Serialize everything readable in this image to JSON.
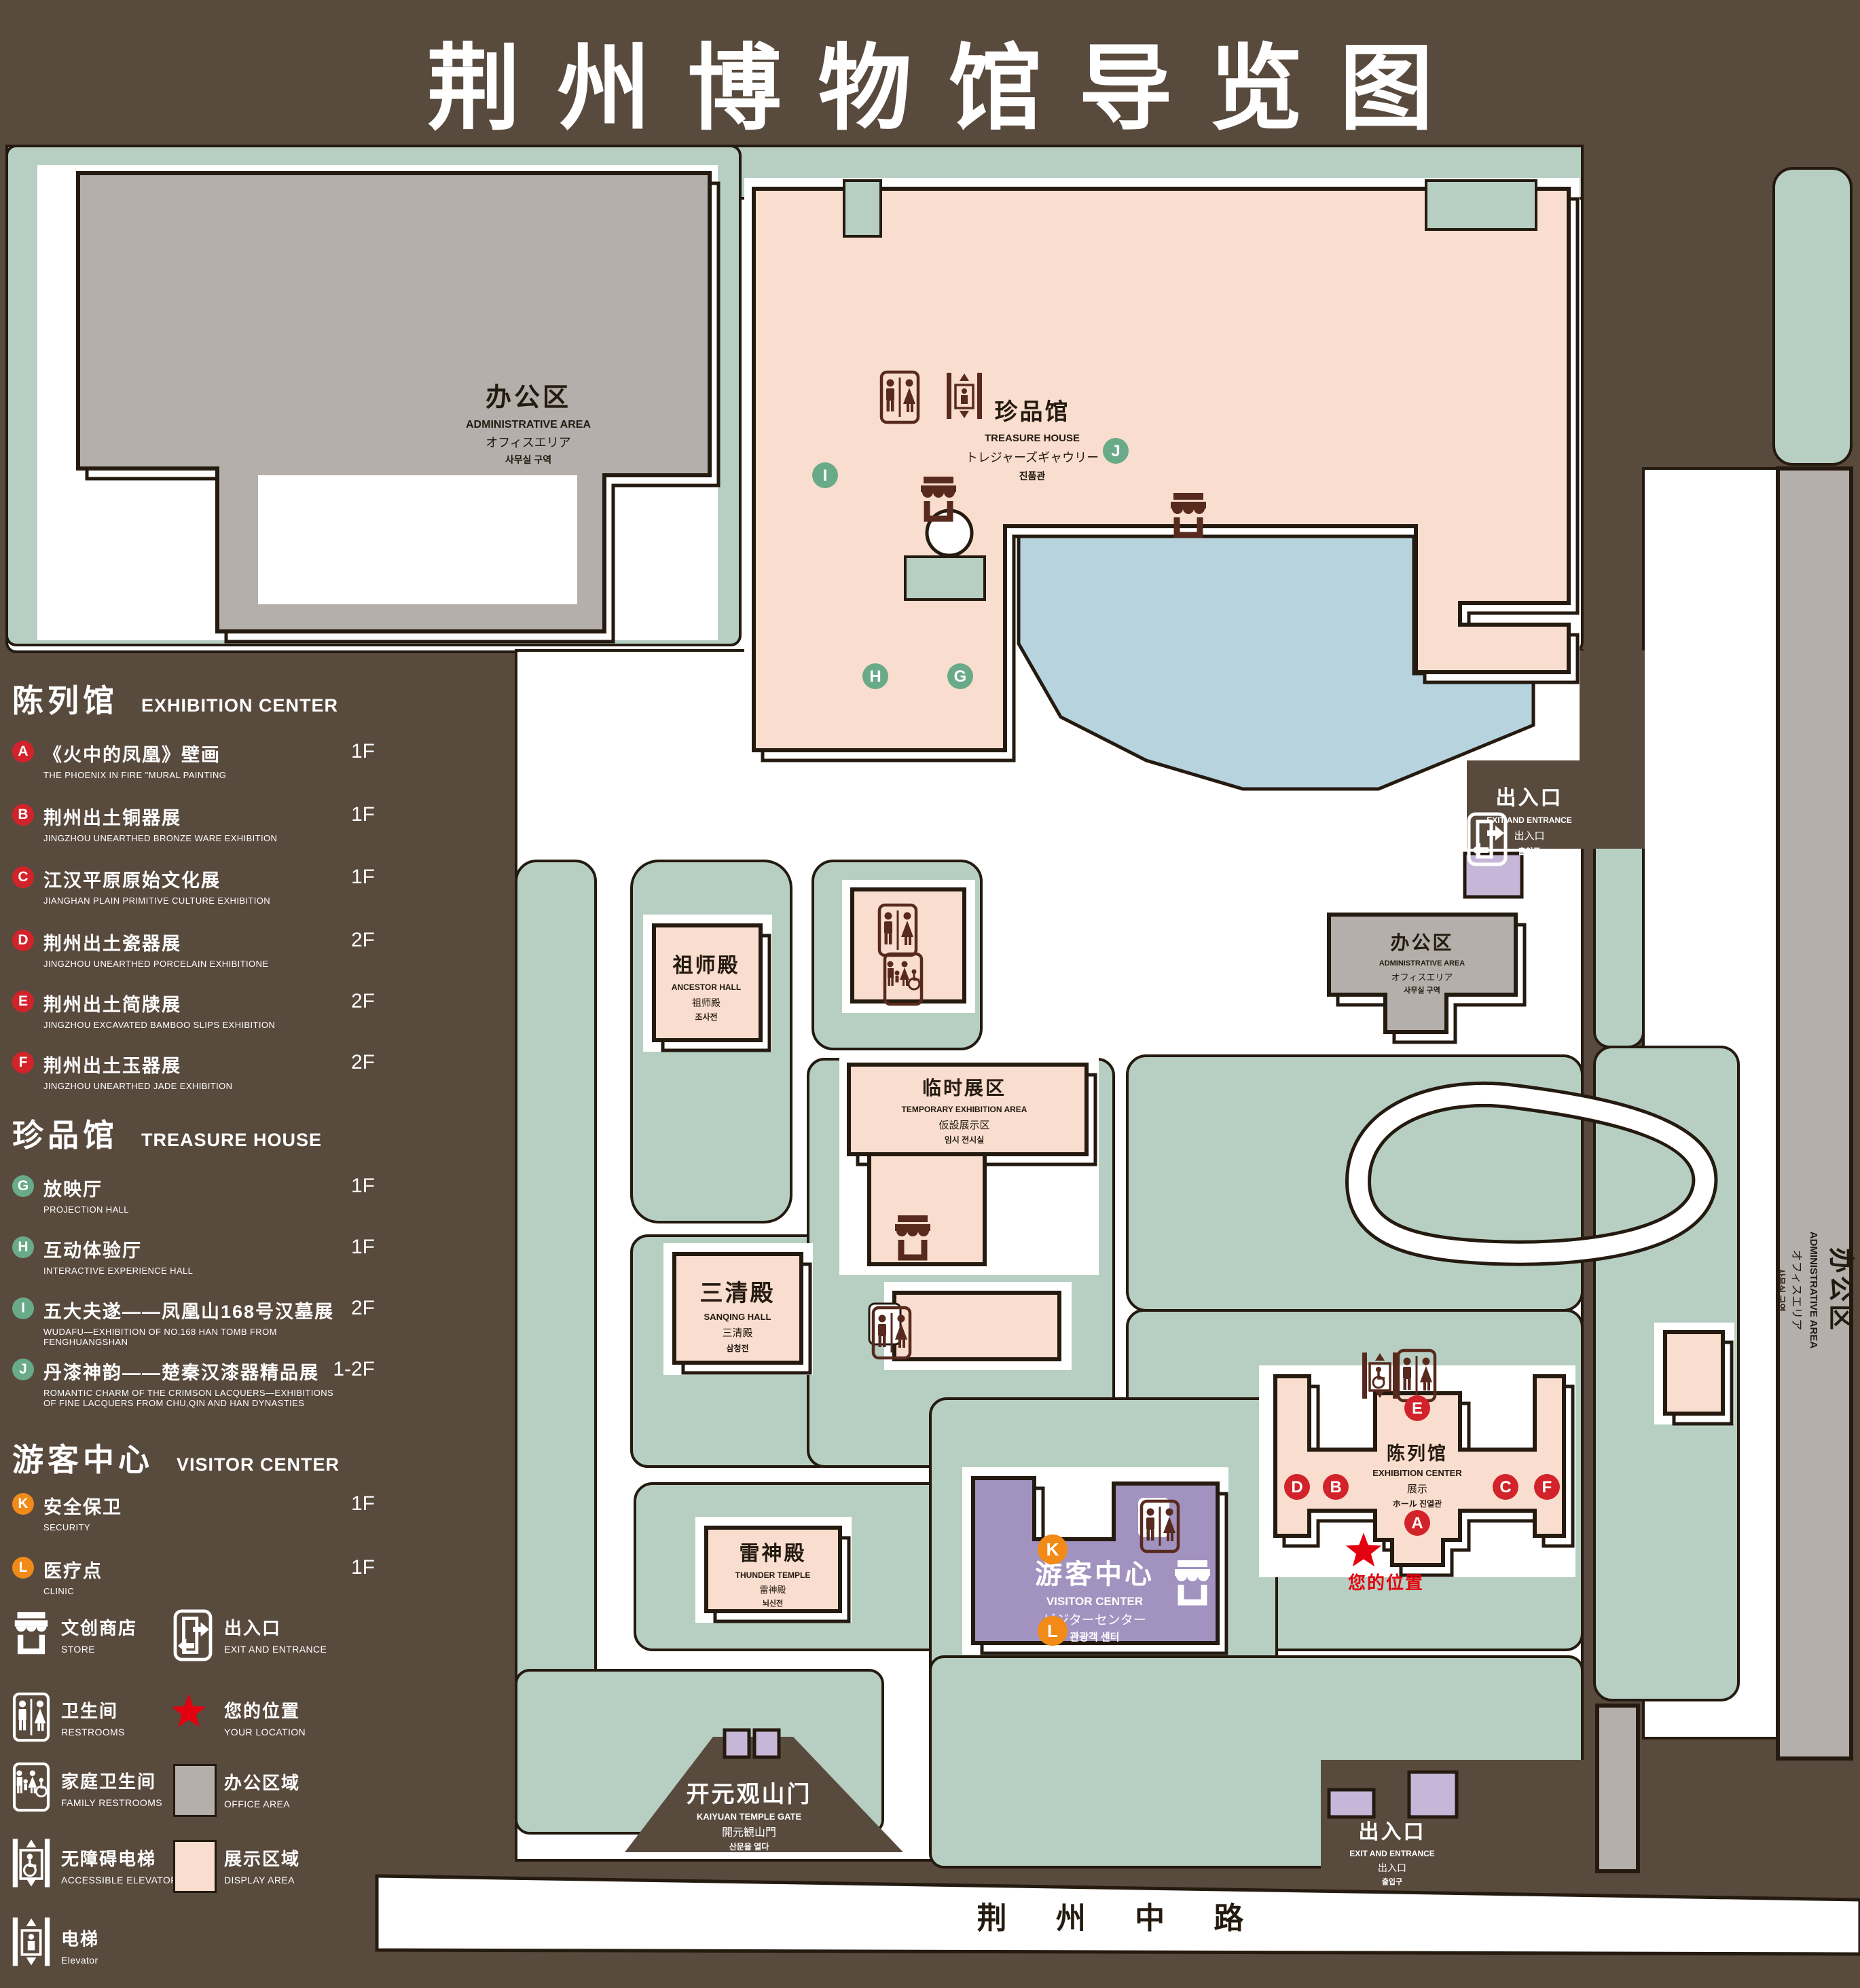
{
  "title": {
    "zh": "荆州博物馆导览图",
    "en": "GUIDE MAP OF JINGZHOU MUSEUM"
  },
  "colors": {
    "background": "#594a3e",
    "lawn": "#b7cfc2",
    "display_area": "#f9ddcf",
    "office_area": "#b4afaa",
    "visitor_center": "#a292c0",
    "gate_purple": "#c6b7d8",
    "pond": "#b7d3de",
    "badge_red": "#d2232a",
    "badge_green": "#69aa88",
    "badge_orange": "#f28a18",
    "location_red": "#e3000f",
    "icon_maroon": "#572a1d"
  },
  "legend": {
    "sections": [
      {
        "zh": "陈列馆",
        "en": "EXHIBITION CENTER",
        "items": [
          {
            "id": "A",
            "zh": "《火中的凤凰》壁画",
            "en": "THE PHOENIX IN FIRE \"MURAL PAINTING",
            "floor": "1F"
          },
          {
            "id": "B",
            "zh": "荆州出土铜器展",
            "en": "JINGZHOU UNEARTHED BRONZE WARE EXHIBITION",
            "floor": "1F"
          },
          {
            "id": "C",
            "zh": "江汉平原原始文化展",
            "en": "JIANGHAN PLAIN PRIMITIVE CULTURE EXHIBITION",
            "floor": "1F"
          },
          {
            "id": "D",
            "zh": "荆州出土瓷器展",
            "en": "JINGZHOU UNEARTHED PORCELAIN EXHIBITIONE",
            "floor": "2F"
          },
          {
            "id": "E",
            "zh": "荆州出土简牍展",
            "en": "JINGZHOU EXCAVATED BAMBOO SLIPS EXHIBITION",
            "floor": "2F"
          },
          {
            "id": "F",
            "zh": "荆州出土玉器展",
            "en": "JINGZHOU UNEARTHED JADE EXHIBITION",
            "floor": "2F"
          }
        ]
      },
      {
        "zh": "珍品馆",
        "en": "TREASURE HOUSE",
        "items": [
          {
            "id": "G",
            "zh": "放映厅",
            "en": "PROJECTION HALL",
            "floor": "1F"
          },
          {
            "id": "H",
            "zh": "互动体验厅",
            "en": "INTERACTIVE EXPERIENCE HALL",
            "floor": "1F"
          },
          {
            "id": "I",
            "zh": "五大夫遂——凤凰山168号汉墓展",
            "en": "WUDAFU—EXHIBITION OF NO.168 HAN TOMB FROM FENGHUANGSHAN",
            "floor": "2F"
          },
          {
            "id": "J",
            "zh": "丹漆神韵——楚秦汉漆器精品展",
            "en": "ROMANTIC CHARM OF THE CRIMSON LACQUERS—EXHIBITIONS OF FINE LACQUERS FROM CHU,QIN AND HAN DYNASTIES",
            "floor": "1-2F"
          }
        ]
      },
      {
        "zh": "游客中心",
        "en": "VISITOR CENTER",
        "items": [
          {
            "id": "K",
            "zh": "安全保卫",
            "en": "SECURITY",
            "floor": "1F"
          },
          {
            "id": "L",
            "zh": "医疗点",
            "en": "CLINIC",
            "floor": "1F"
          }
        ]
      }
    ],
    "facilities": [
      {
        "id": "store",
        "zh": "文创商店",
        "en": "STORE"
      },
      {
        "id": "exit",
        "zh": "出入口",
        "en": "EXIT AND ENTRANCE"
      },
      {
        "id": "restrooms",
        "zh": "卫生间",
        "en": "RESTROOMS"
      },
      {
        "id": "your-location",
        "zh": "您的位置",
        "en": "YOUR LOCATION"
      },
      {
        "id": "family-restrooms",
        "zh": "家庭卫生间",
        "en": "FAMILY RESTROOMS"
      },
      {
        "id": "office-area",
        "zh": "办公区域",
        "en": "OFFICE AREA",
        "swatch": "#b4afaa"
      },
      {
        "id": "accessible-elevator",
        "zh": "无障碍电梯",
        "en": "ACCESSIBLE ELEVATOR"
      },
      {
        "id": "display-area",
        "zh": "展示区域",
        "en": "DISPLAY AREA",
        "swatch": "#f9ddcf"
      },
      {
        "id": "elevator",
        "zh": "电梯",
        "en": "Elevator"
      }
    ]
  },
  "map": {
    "buildings": {
      "admin_nw": {
        "zh": "办公区",
        "en": "ADMINISTRATIVE AREA",
        "ja": "オフィスエリア",
        "ko": "사무실 구역"
      },
      "treasure": {
        "zh": "珍品馆",
        "en": "TREASURE HOUSE",
        "ja": "トレジャーズギャウリー",
        "ko": "진품관"
      },
      "ancestor": {
        "zh": "祖师殿",
        "en": "ANCESTOR HALL",
        "ja": "祖师殿",
        "ko": "조사전"
      },
      "temporary": {
        "zh": "临时展区",
        "en": "TEMPORARY EXHIBITION AREA",
        "ja": "仮設展示区",
        "ko": "임시 전시실"
      },
      "sanqing": {
        "zh": "三清殿",
        "en": "SANQING HALL",
        "ja": "三清殿",
        "ko": "삼청전"
      },
      "thunder": {
        "zh": "雷神殿",
        "en": "THUNDER TEMPLE",
        "ja": "雷神殿",
        "ko": "뇌신전"
      },
      "visitor": {
        "zh": "游客中心",
        "en": "VISITOR CENTER",
        "ja": "ビジターセンター",
        "ko": "관광객 센터"
      },
      "exhibition": {
        "zh": "陈列馆",
        "en": "EXHIBITION CENTER",
        "ja": "展示",
        "ko": "ホール 진열관"
      },
      "admin_e": {
        "zh": "办公区",
        "en": "ADMINISTRATIVE AREA",
        "ja": "オフィスエリア",
        "ko": "사무실 구역"
      },
      "admin_strip": {
        "zh": "办公区",
        "en": "ADMINISTRATIVE AREA",
        "ja": "オフィスエリア",
        "ko": "사무실 구역"
      }
    },
    "labels": {
      "exit_ne": {
        "zh": "出入口",
        "en": "EXIT AND ENTRANCE",
        "ja": "出入口",
        "ko": "출입구"
      },
      "exit_s": {
        "zh": "出入口",
        "en": "EXIT AND ENTRANCE",
        "ja": "出入口",
        "ko": "출입구"
      },
      "gate": {
        "zh": "开元观山门",
        "en": "KAIYUAN TEMPLE GATE",
        "ja": "開元観山門",
        "ko": "산문을 열다"
      },
      "road": "荆 州 中 路",
      "your_location": "您的位置"
    },
    "markers": {
      "A": "A",
      "B": "B",
      "C": "C",
      "D": "D",
      "E": "E",
      "F": "F",
      "G": "G",
      "H": "H",
      "I": "I",
      "J": "J",
      "K": "K",
      "L": "L"
    }
  }
}
